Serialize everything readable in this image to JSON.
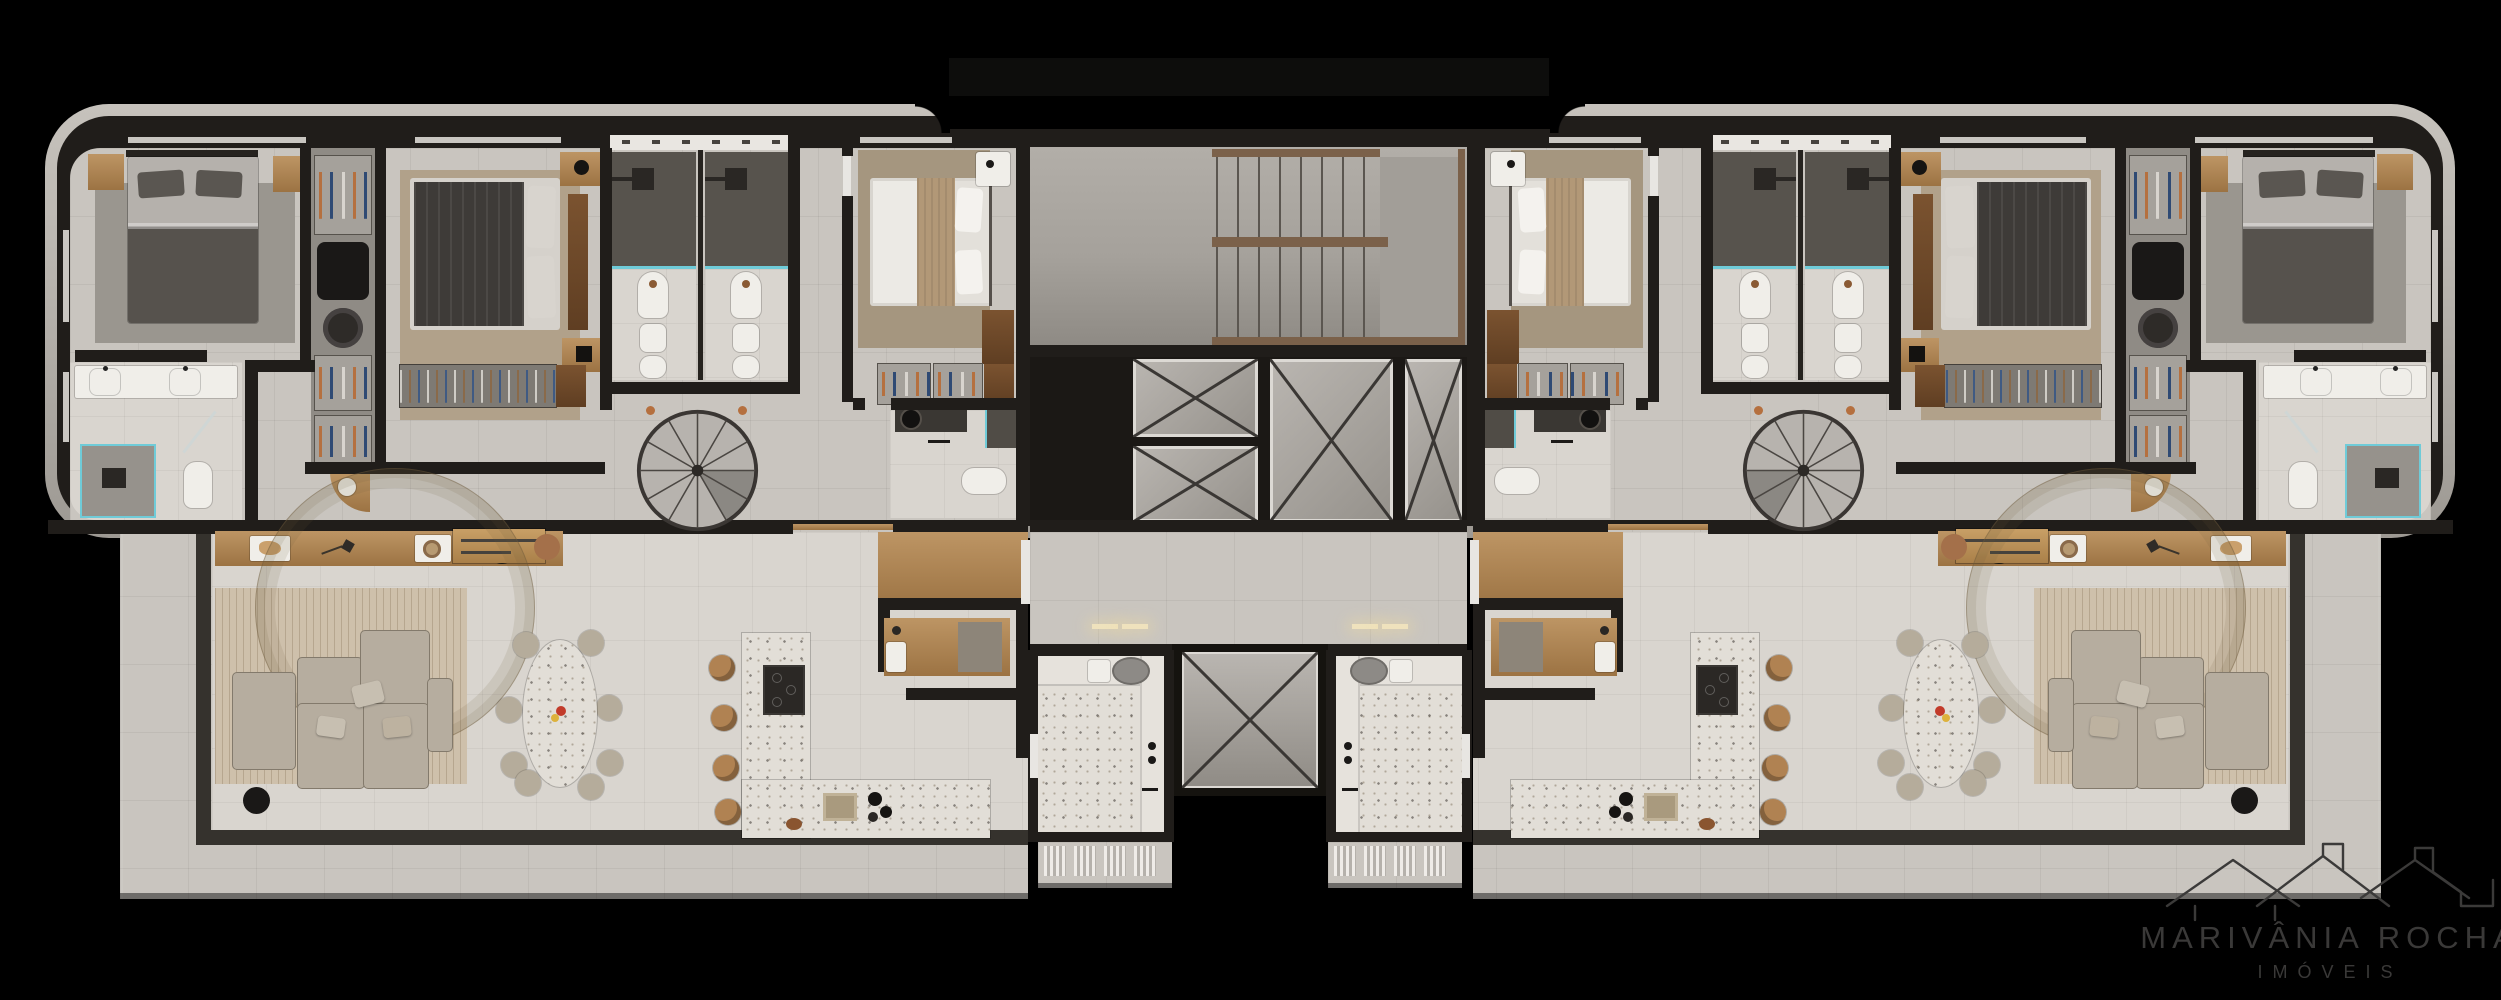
{
  "scene": {
    "kind": "architectural-floor-plan-render",
    "view": "top-down 3D render of one residential floor",
    "background": "black",
    "units_visible": 2,
    "layout": "two mirrored apartments flanking a shared central circulation core"
  },
  "watermark": {
    "brand": "MARIVÂNIA ROCHA",
    "tagline": "IMÓVEIS",
    "icon": "rooftops-outline-icon"
  },
  "building": {
    "core": {
      "rooms": [
        "stair-hall",
        "switchback-staircase",
        "elevator-bank",
        "shared-corridor",
        "service-shaft"
      ],
      "elevator_shaft_count": 4,
      "shaft_marking": "X-crossed voids"
    },
    "units": [
      {
        "id": "unit-a",
        "side": "left",
        "rooms": [
          "master-bedroom",
          "master-bathroom",
          "walk-in-closet",
          "bedroom-2",
          "bathroom-1",
          "bathroom-2",
          "bedroom-3",
          "bedroom-3-bathroom",
          "spiral-stair-hall",
          "entry-foyer",
          "home-office",
          "laundry",
          "kitchen",
          "dining-area",
          "living-room",
          "wrap-around-balcony"
        ]
      },
      {
        "id": "unit-b",
        "side": "right",
        "mirror_of": "unit-a"
      }
    ]
  },
  "furniture": {
    "master-bedroom": [
      "double-bed",
      "nightstand-left",
      "nightstand-right",
      "area-rug"
    ],
    "master-bathroom": [
      "double-vanity",
      "two-sinks",
      "glass-shower",
      "toilet"
    ],
    "walk-in-closet": [
      "shoe-shelves",
      "garment-bag",
      "hat-box",
      "corner-shelf"
    ],
    "bedroom-2": [
      "double-bed-dark",
      "wood-nightstand-top",
      "wood-nightstand-bottom",
      "wall-desk",
      "closet-rail"
    ],
    "bathroom-1": [
      "shower",
      "glass-screen",
      "sink",
      "bidet",
      "toilet",
      "cabinet-row"
    ],
    "bathroom-2": [
      "shower",
      "glass-screen",
      "sink",
      "bidet",
      "toilet",
      "cabinet-row"
    ],
    "bedroom-3": [
      "double-bed-light",
      "white-nightstand",
      "wood-dresser",
      "shoe-rack"
    ],
    "bedroom-3-bathroom": [
      "vanity-round-basin",
      "toilet",
      "shower"
    ],
    "living-room": [
      "modular-sofa",
      "cushions",
      "patterned-rug",
      "round-side-table",
      "wood-console"
    ],
    "dining-area": [
      "oval-terrazzo-table",
      "dining-chairs-x8",
      "fruit-bowl"
    ],
    "kitchen": [
      "l-shaped-terrazzo-island",
      "cooktop",
      "sink",
      "coffee-station",
      "bar-stools-x4"
    ],
    "home-office": [
      "desk",
      "chair",
      "printer"
    ],
    "laundry": [
      "utility-sink",
      "oval-wash-basin",
      "counter",
      "drying-units"
    ],
    "circulation": [
      "spiral-staircase",
      "switchback-staircase",
      "elevator-cabs"
    ]
  },
  "colors": {
    "background": "#000000",
    "roof-trim": "#bcb8b2",
    "wall": "#201d1a",
    "floor-tile": "#c9c5bf",
    "floor-tile-light": "#d9d5cf",
    "floor-concrete": "#a5a19b",
    "terrazzo": "#e2ded7",
    "wood": "#b08a58",
    "wood-dark": "#6e4b2c",
    "rug-gray": "#9a968f",
    "rug-tan": "#b1a18a",
    "rug-living": "#cec0ab",
    "sofa": "#b6ad9f",
    "bed-dark": "#3e3b38",
    "linen-white": "#eceae5",
    "glass-teal": "#6fcbd8",
    "fixture-white": "#f0eee9",
    "accent-copper": "#a4704a",
    "accent-red": "#c23b2a",
    "accent-yellow": "#ddb23c",
    "watermark": "#3a3938"
  }
}
